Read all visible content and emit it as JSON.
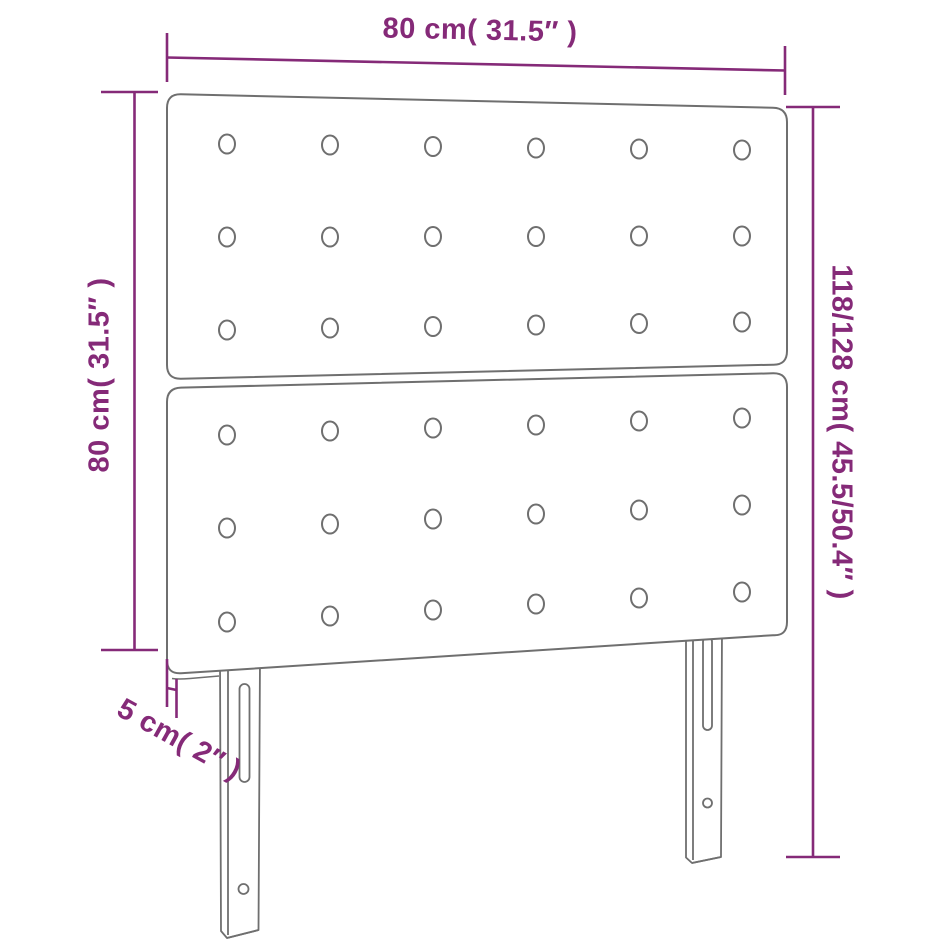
{
  "diagram": {
    "type": "product-dimension-diagram",
    "subject": "upholstered headboard with two tufted panels and two slotted legs",
    "labels": {
      "width": "80 cm( 31.5″ )",
      "panel_height": "80 cm( 31.5″ )",
      "total_height": "118/128 cm( 45.5/50.4″ )",
      "depth": "5 cm( 2″ )"
    },
    "colors": {
      "dimension_accent": "#852a78",
      "outline_gray": "#6f6f6f",
      "background": "#ffffff"
    },
    "counts": {
      "panels": 2,
      "buttons_per_panel": 18,
      "button_columns": 6,
      "button_rows_per_panel": 3,
      "legs": 2
    }
  }
}
